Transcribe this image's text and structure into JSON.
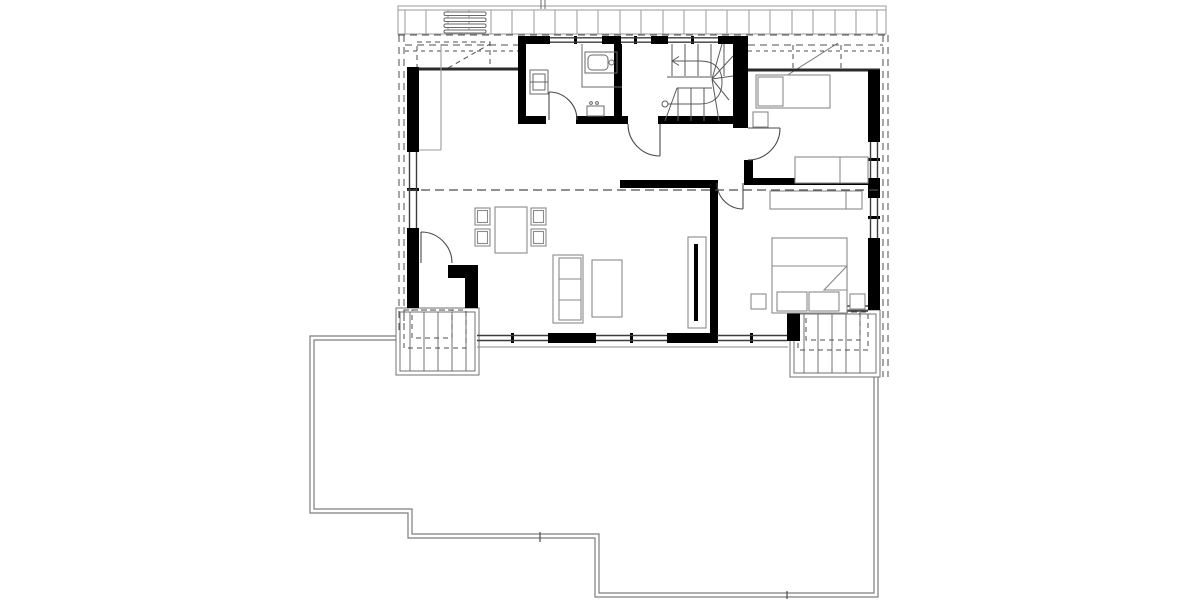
{
  "document": {
    "kind": "architectural-floor-plan",
    "view": "upper floor plan of a house with dormer, winder staircase, two balconies and ground terrace outline",
    "visible_text": "",
    "scale_bar": "none"
  },
  "colors": {
    "background": "#ffffff",
    "walls": "#000000",
    "window_line": "#3c3c3c",
    "door_line": "#4a4a4a",
    "stair_line": "#5a5a5a",
    "fixture_line": "#6a6a6a",
    "furniture_line": "#8a8a8a",
    "deck_line": "#9a9a9a",
    "terrace_line": "#7d7d7d",
    "dashed_line": "#4d4d4d",
    "thin_line": "#707070"
  },
  "rooms": [
    {
      "id": "bathroom",
      "position": "top-center-left",
      "fixtures": [
        "bathtub",
        "washbasin-unit",
        "small-sink",
        "door"
      ]
    },
    {
      "id": "staircase",
      "position": "top-center-right",
      "features": [
        "straight-flight",
        "winder-fan-steps",
        "walking-line-with-arrow",
        "start-circle"
      ]
    },
    {
      "id": "hall",
      "position": "center",
      "features": [
        "openings-to-living-room",
        "doors-to-bathroom-stair-kids-room-bedroom"
      ]
    },
    {
      "id": "living-dining-room",
      "position": "left",
      "furniture": [
        "dining-table",
        "four-chairs",
        "sofa",
        "coffee-table",
        "radiator",
        "built-in-closet"
      ],
      "features": [
        "balcony-door-west"
      ]
    },
    {
      "id": "kids-room",
      "position": "top-right",
      "furniture": [
        "single-bed-with-pillow",
        "nightstand",
        "desk-sofa"
      ]
    },
    {
      "id": "bedroom",
      "position": "bottom-right",
      "furniture": [
        "double-bed-with-pillows-and-folded-corner",
        "two-nightstands",
        "wardrobe"
      ]
    },
    {
      "id": "balcony-west",
      "position": "bottom-left-of-building",
      "features": [
        "plank-decking",
        "dashed-roof-overhang"
      ]
    },
    {
      "id": "balcony-south",
      "position": "bottom-right-of-building",
      "features": [
        "plank-decking",
        "dashed-roof-overhang"
      ]
    },
    {
      "id": "roof-deck-band",
      "position": "top",
      "features": [
        "plank-decking",
        "four-slat-grille",
        "vent-mark"
      ]
    },
    {
      "id": "terrace",
      "position": "bottom",
      "features": [
        "stepped-outline-double-line",
        "joint-ticks"
      ]
    }
  ],
  "openings": {
    "windows_top_dormer": 3,
    "windows_bottom_facade": 3,
    "window_left_facade": 1,
    "windows_right_facade": 2,
    "window_bedroom_south": 1,
    "interior_doors": 4,
    "balcony_doors": 1
  },
  "linework": {
    "dashed_roof_eave_line_across_plan": true,
    "dashed_overhang_outline_left_right_top": true,
    "knee_wall_lines_under_roof_slope": true,
    "diagonal_slope_marks_in_top_corners": 2
  }
}
